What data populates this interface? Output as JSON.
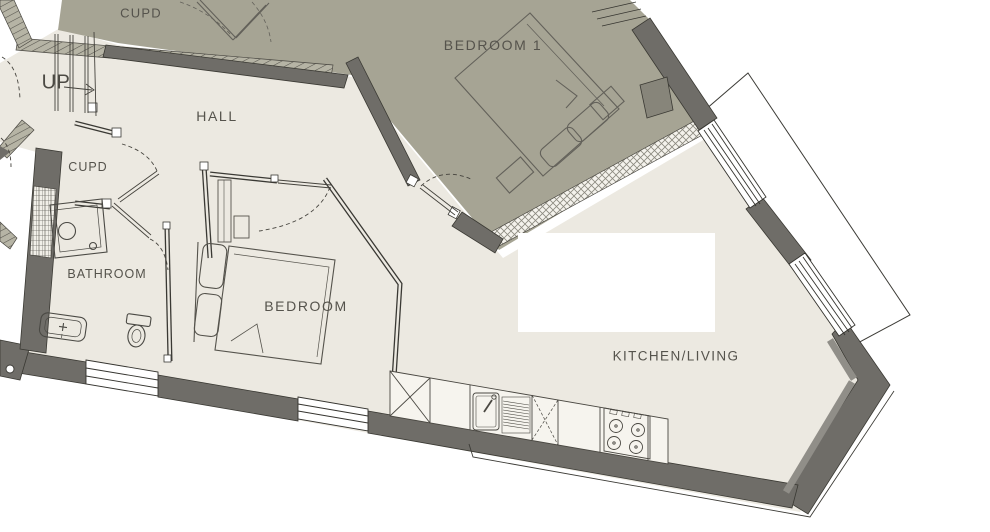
{
  "plan": {
    "type": "apartment-floor-plan",
    "rooms": [
      {
        "id": "cupd-top",
        "label": "CUPD"
      },
      {
        "id": "bedroom1",
        "label": "BEDROOM 1"
      },
      {
        "id": "hall",
        "label": "HALL"
      },
      {
        "id": "cupd-hall",
        "label": "CUPD"
      },
      {
        "id": "bathroom",
        "label": "BATHROOM"
      },
      {
        "id": "bedroom",
        "label": "BEDROOM"
      },
      {
        "id": "kitchen-living",
        "label": "KITCHEN/LIVING"
      }
    ],
    "stairs": {
      "label": "UP",
      "direction": "right"
    },
    "fixtures": [
      "shower",
      "basin",
      "toilet",
      "double-bed",
      "double-bed-adjacent",
      "kitchen-sink",
      "hob",
      "kitchen-counter",
      "wardrobe",
      "balcony"
    ],
    "colors": {
      "floor_main": "#ece9e1",
      "floor_adjacent_unit": "#a6a494",
      "wall_dark": "#6f6d68",
      "wall_light_face": "#908e88",
      "hatch_band": "#b6b4a5",
      "line_art": "#45433d",
      "outside": "#ffffff",
      "label_text": "#55534c"
    }
  }
}
